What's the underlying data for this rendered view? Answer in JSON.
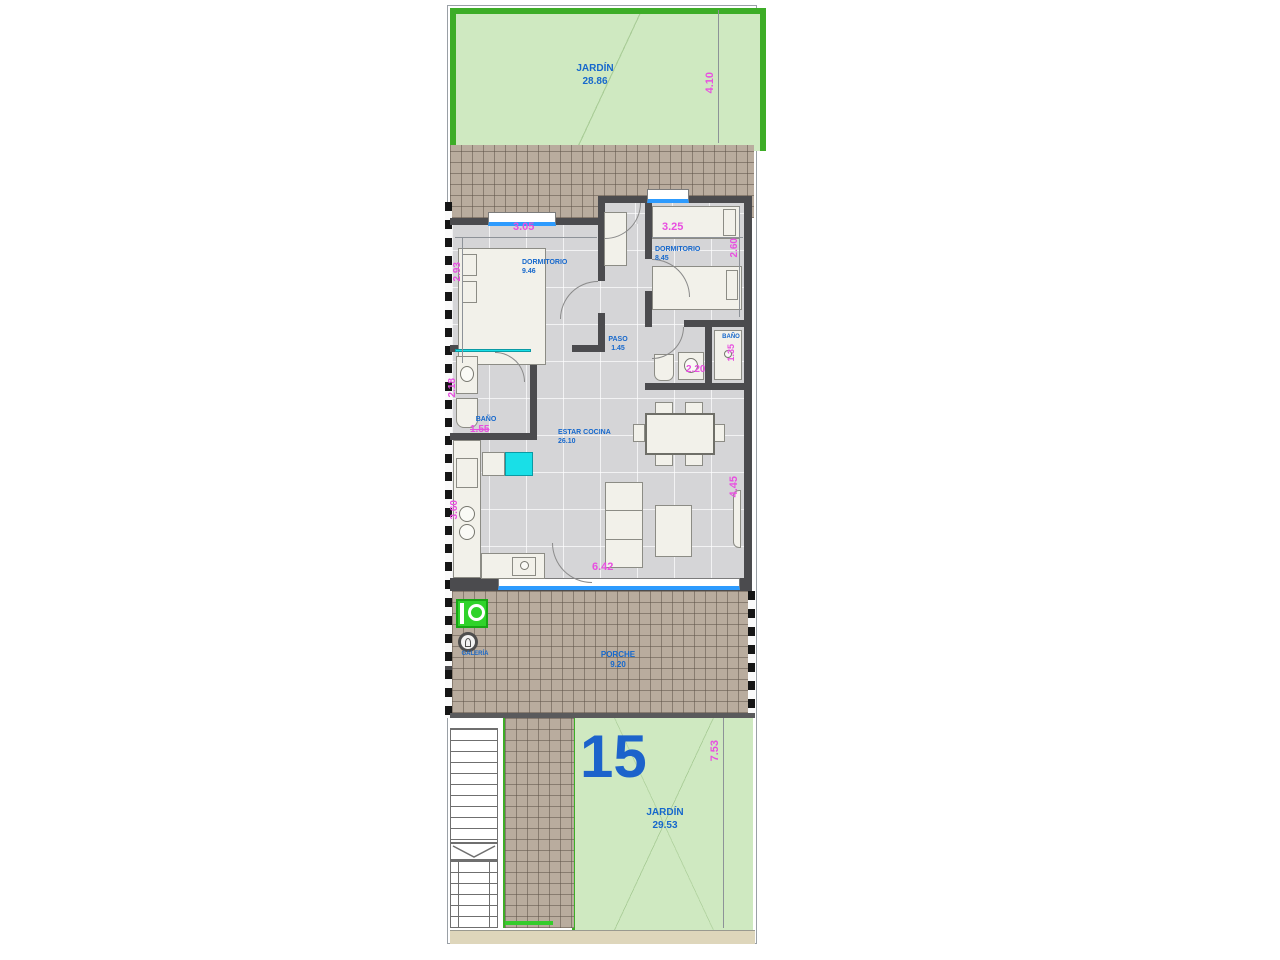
{
  "unit_number": "15",
  "rooms": {
    "garden_top": {
      "name": "JARDÍN",
      "area": "28.86"
    },
    "bedroom_main": {
      "name": "DORMITORIO",
      "area": "9.46"
    },
    "bedroom_second": {
      "name": "DORMITORIO",
      "area": "8.45"
    },
    "hallway": {
      "name": "PASO",
      "area": "1.45"
    },
    "bathroom_main": {
      "name": "BAÑO"
    },
    "bathroom_second": {
      "name": "BAÑO"
    },
    "living_kitchen": {
      "name": "ESTAR COCINA",
      "area": "26.10"
    },
    "gallery": {
      "name": "GALERÍA"
    },
    "porch": {
      "name": "PORCHE",
      "area": "9.20"
    },
    "garden_bottom": {
      "name": "JARDÍN",
      "area": "29.53"
    }
  },
  "dimensions": {
    "garden_top_depth": "4.10",
    "bedroom_main_width": "3.05",
    "bedroom_main_depth": "2.93",
    "bedroom_second_width": "3.25",
    "bedroom_second_depth": "2.60",
    "bathroom_main_width": "1.55",
    "bathroom_main_depth": "2.18",
    "bathroom_second_width": "2.20",
    "bathroom_second_depth": "1.35",
    "living_width": "6.42",
    "living_depth": "4.45",
    "kitchen_depth": "3.60",
    "garden_bottom_depth": "7.53"
  },
  "colors": {
    "garden_fill": "#cfe9c1",
    "garden_border": "#3dad27",
    "tile_fill": "#b9ac9e",
    "floor_fill": "#d5d5d7",
    "wall": "#4b4b4e",
    "window_blue": "#2d9bfe",
    "fixture_cyan": "#19dfe7",
    "label_blue": "#1668cc",
    "dimension_pink": "#e84fe0",
    "appliance_green": "#2fd32a"
  }
}
